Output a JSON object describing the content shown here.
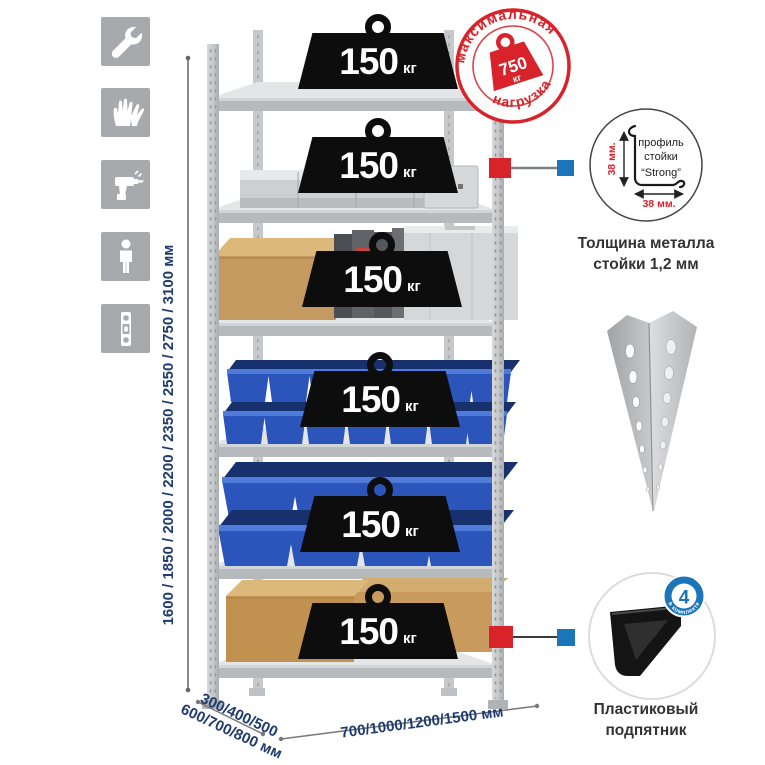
{
  "sidebar": {
    "icons": [
      {
        "name": "wrench"
      },
      {
        "name": "gloves"
      },
      {
        "name": "drill"
      },
      {
        "name": "person"
      },
      {
        "name": "spirit-level"
      }
    ]
  },
  "dimensions": {
    "height_label": "1600 / 1850 / 2000 / 2200 / 2350 / 2550 / 2750 / 3100 мм",
    "depth_label_line1": "300/400/500",
    "depth_label_line2": "600/700/800 мм",
    "width_label": "700/1000/1200/1500 мм"
  },
  "rack": {
    "weights": [
      {
        "value": "150",
        "unit": "кг"
      },
      {
        "value": "150",
        "unit": "кг"
      },
      {
        "value": "150",
        "unit": "кг"
      },
      {
        "value": "150",
        "unit": "кг"
      },
      {
        "value": "150",
        "unit": "кг"
      },
      {
        "value": "150",
        "unit": "кг"
      }
    ]
  },
  "max_load_stamp": {
    "arc_top": "максимальная",
    "arc_bottom": "нагрузка",
    "weight_value": "750",
    "weight_unit": "кг"
  },
  "profile_detail": {
    "line1": "профиль",
    "line2": "стойки",
    "line3": "“Strong”",
    "vertical_dim": "38 мм.",
    "horizontal_dim": "38 мм.",
    "caption_line1": "Толщина металла",
    "caption_line2": "стойки 1,2 мм"
  },
  "foot_detail": {
    "badge_value": "4",
    "badge_arc": "в комплекте",
    "caption_line1": "Пластиковый",
    "caption_line2": "подпятник"
  },
  "colors": {
    "accent_red": "#d8232a",
    "accent_blue": "#1b75bb",
    "bin_blue": "#2b55bb",
    "navy_text": "#1f3b70",
    "tile_gray": "#a7aaad"
  }
}
